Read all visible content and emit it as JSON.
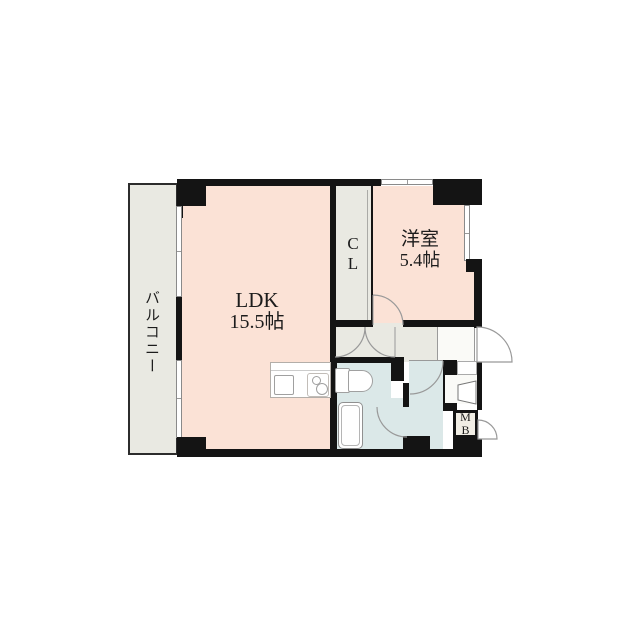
{
  "rooms": {
    "balcony": {
      "label": "バルコニー"
    },
    "ldk": {
      "name": "LDK",
      "size": "15.5帖"
    },
    "closet": {
      "char1": "C",
      "char2": "L"
    },
    "western_room": {
      "name": "洋室",
      "size": "5.4帖"
    },
    "meter_box": {
      "char1": "M",
      "char2": "B"
    }
  },
  "icons": {
    "kitchen": "sink-and-stove-icon",
    "toilet": "toilet-icon",
    "bathtub": "bathtub-icon",
    "washbasin": "washbasin-icon"
  },
  "colors": {
    "room_pink": "#fbe2d6",
    "service_gray": "#e9e9e2",
    "wet_area_blue": "#dbe8e8",
    "entry_white": "#fafaf7",
    "wall_black": "#141414",
    "meter_box_bg": "#f1eee5"
  }
}
